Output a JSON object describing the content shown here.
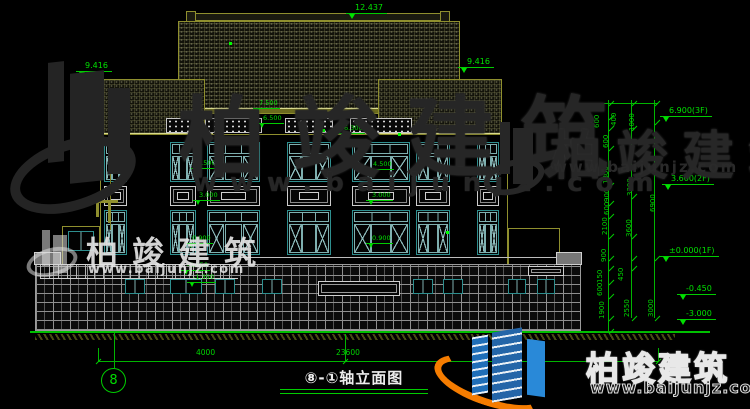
{
  "watermark": {
    "brand": "柏竣建筑",
    "brand2": "柏竣建筑",
    "url": "www.baijunjz.com"
  },
  "titlebar": {
    "title": "⑧-①轴立面图",
    "axis_left": "8",
    "axis_right": "1"
  },
  "bottom_dims": [
    {
      "text": "4000",
      "x": 196,
      "y": 349
    },
    {
      "text": "23600",
      "x": 336,
      "y": 349
    }
  ],
  "roof_markers": [
    {
      "text": "12.437",
      "x": 346,
      "y": 3
    },
    {
      "text": "9.416",
      "x": 76,
      "y": 61
    },
    {
      "text": "9.416",
      "x": 458,
      "y": 57
    }
  ],
  "facade_markers": [
    {
      "text": "7.500",
      "x": 253,
      "y": 100
    },
    {
      "text": "6.500",
      "x": 257,
      "y": 115
    },
    {
      "text": "6.300",
      "x": 338,
      "y": 125
    },
    {
      "text": "4.500",
      "x": 191,
      "y": 160
    },
    {
      "text": "3.000",
      "x": 193,
      "y": 192
    },
    {
      "text": "0.900",
      "x": 186,
      "y": 235
    },
    {
      "text": "-0.450",
      "x": 181,
      "y": 262
    },
    {
      "text": "-1.350",
      "x": 187,
      "y": 274
    },
    {
      "text": "4.500",
      "x": 367,
      "y": 161
    },
    {
      "text": "3.000",
      "x": 366,
      "y": 192
    },
    {
      "text": "0.900",
      "x": 366,
      "y": 235
    }
  ],
  "right_levels": [
    {
      "text": "6.900(3F)",
      "x": 660,
      "y": 106
    },
    {
      "text": "3.600(2F)",
      "x": 662,
      "y": 174
    },
    {
      "text": "±0.000(1F)",
      "x": 660,
      "y": 246
    },
    {
      "text": "-0.450",
      "x": 677,
      "y": 284
    },
    {
      "text": "-3.000",
      "x": 677,
      "y": 309
    }
  ],
  "right_dims": [
    {
      "text": "600",
      "x": 594,
      "y": 128
    },
    {
      "text": "400",
      "x": 611,
      "y": 126
    },
    {
      "text": "1000",
      "x": 629,
      "y": 131
    },
    {
      "text": "600",
      "x": 603,
      "y": 148
    },
    {
      "text": "1800",
      "x": 603,
      "y": 184
    },
    {
      "text": "3300",
      "x": 627,
      "y": 196
    },
    {
      "text": "900",
      "x": 604,
      "y": 202
    },
    {
      "text": "600",
      "x": 604,
      "y": 215
    },
    {
      "text": "2100",
      "x": 602,
      "y": 235
    },
    {
      "text": "3600",
      "x": 626,
      "y": 237
    },
    {
      "text": "6900",
      "x": 650,
      "y": 212
    },
    {
      "text": "900",
      "x": 601,
      "y": 262
    },
    {
      "text": "450",
      "x": 618,
      "y": 281
    },
    {
      "text": "150",
      "x": 597,
      "y": 283
    },
    {
      "text": "600",
      "x": 597,
      "y": 296
    },
    {
      "text": "1900",
      "x": 599,
      "y": 319
    },
    {
      "text": "2550",
      "x": 624,
      "y": 317
    },
    {
      "text": "3000",
      "x": 648,
      "y": 317
    }
  ],
  "ticks": [
    {
      "x": 608,
      "y": 103
    },
    {
      "x": 608,
      "y": 117
    },
    {
      "x": 608,
      "y": 128
    },
    {
      "x": 608,
      "y": 148
    },
    {
      "x": 608,
      "y": 185
    },
    {
      "x": 608,
      "y": 203
    },
    {
      "x": 608,
      "y": 216
    },
    {
      "x": 608,
      "y": 236
    },
    {
      "x": 608,
      "y": 258
    },
    {
      "x": 608,
      "y": 268
    },
    {
      "x": 608,
      "y": 282
    },
    {
      "x": 608,
      "y": 296
    },
    {
      "x": 608,
      "y": 318
    },
    {
      "x": 608,
      "y": 331
    },
    {
      "x": 631,
      "y": 103
    },
    {
      "x": 631,
      "y": 128
    },
    {
      "x": 631,
      "y": 196
    },
    {
      "x": 631,
      "y": 236
    },
    {
      "x": 631,
      "y": 258
    },
    {
      "x": 631,
      "y": 268
    },
    {
      "x": 631,
      "y": 318
    },
    {
      "x": 654,
      "y": 103
    },
    {
      "x": 654,
      "y": 122
    },
    {
      "x": 654,
      "y": 258
    },
    {
      "x": 654,
      "y": 318
    }
  ],
  "dots": [
    {
      "x": 229,
      "y": 42
    },
    {
      "x": 322,
      "y": 129
    },
    {
      "x": 398,
      "y": 133
    },
    {
      "x": 446,
      "y": 231
    }
  ]
}
